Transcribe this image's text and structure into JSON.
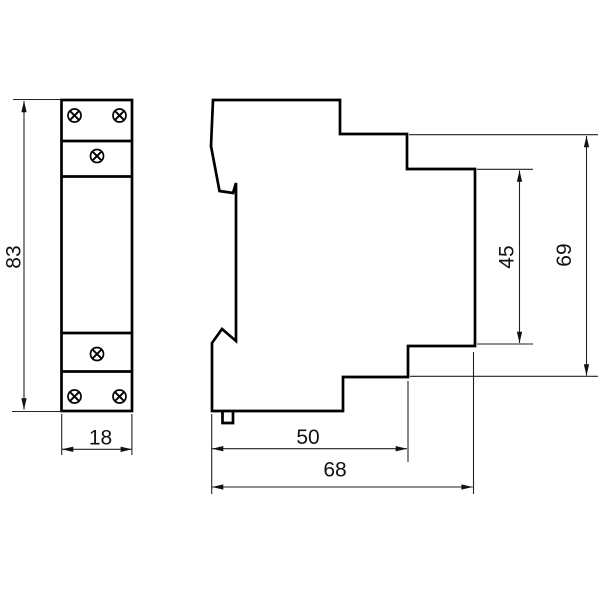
{
  "dimensions": {
    "front_height": "83",
    "front_width": "18",
    "rail_depth": "50",
    "overall_depth": "68",
    "rear_height": "45",
    "overall_height": "69"
  },
  "front_view": {
    "screw_icon": "circle-with-diagonal-cross-screw-head",
    "screws": [
      {
        "cx": 74.5,
        "cy": 115.5
      },
      {
        "cx": 119.5,
        "cy": 115.5
      },
      {
        "cx": 97,
        "cy": 156
      },
      {
        "cx": 97,
        "cy": 354
      },
      {
        "cx": 74.5,
        "cy": 396.5
      },
      {
        "cx": 119.5,
        "cy": 396.5
      }
    ]
  },
  "colors": {
    "line": "#000000",
    "thin_line": "#222222",
    "background": "#ffffff"
  }
}
